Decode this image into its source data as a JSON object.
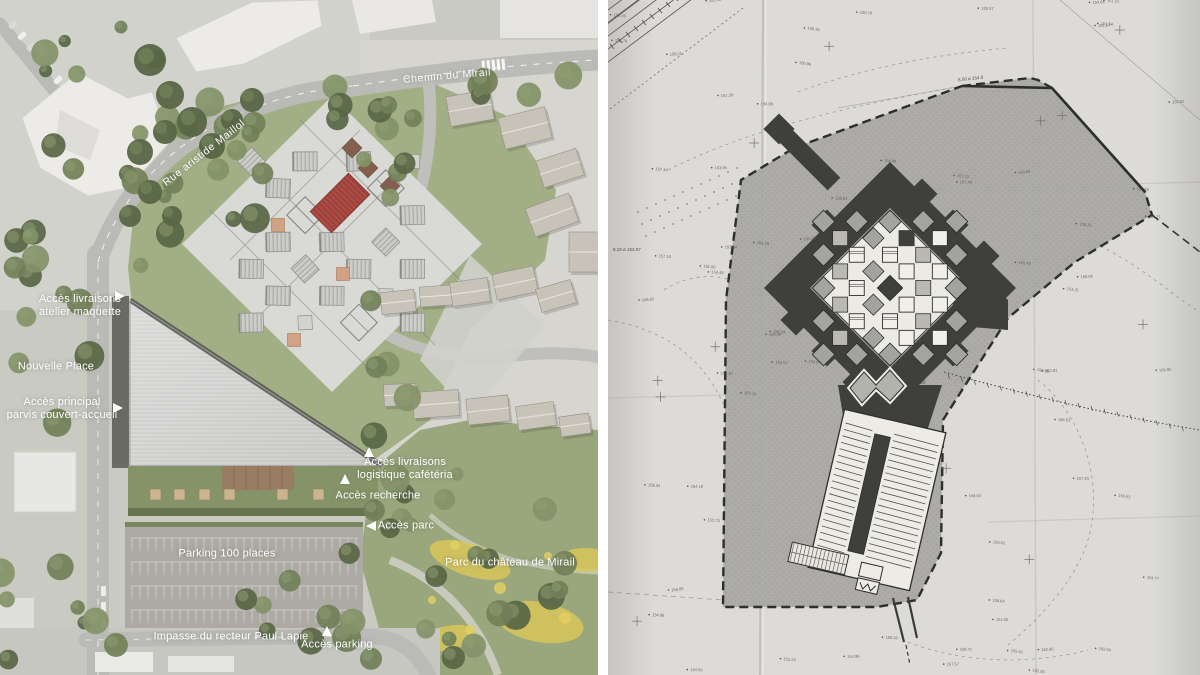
{
  "panels": {
    "left": {
      "type": "aerial-render-site-plan",
      "street_labels": [
        {
          "id": "chemin-du-mirail",
          "text": "Chemin du Mirail",
          "x": 447,
          "y": 76,
          "rotate": -5
        },
        {
          "id": "rue-aristide-maillol",
          "text": "Rue aristide Maillol",
          "x": 204,
          "y": 153,
          "rotate": -38
        }
      ],
      "callouts": [
        {
          "id": "acces-livraisons-atelier",
          "lines": [
            "Accès livraisons",
            "atelier maquette"
          ],
          "x": 80,
          "y": 306,
          "arrow": "right",
          "ax": 120,
          "ay": 296
        },
        {
          "id": "nouvelle-place",
          "lines": [
            "Nouvelle Place"
          ],
          "x": 56,
          "y": 367,
          "arrow": null,
          "ax": 0,
          "ay": 0
        },
        {
          "id": "acces-principal",
          "lines": [
            "Accès principal",
            "parvis couvert-accueil"
          ],
          "x": 62,
          "y": 409,
          "arrow": "right",
          "ax": 118,
          "ay": 408
        },
        {
          "id": "acces-livraisons-logistique",
          "lines": [
            "Accès livraisons",
            "logistique cafétéria"
          ],
          "x": 405,
          "y": 469,
          "arrow": "up",
          "ax": 369,
          "ay": 452
        },
        {
          "id": "acces-recherche",
          "lines": [
            "Accès recherche"
          ],
          "x": 378,
          "y": 496,
          "arrow": "up",
          "ax": 345,
          "ay": 479
        },
        {
          "id": "acces-parc",
          "lines": [
            "Accès parc"
          ],
          "x": 406,
          "y": 526,
          "arrow": "left",
          "ax": 371,
          "ay": 526
        },
        {
          "id": "parking-100-places",
          "lines": [
            "Parking 100 places"
          ],
          "x": 227,
          "y": 554,
          "arrow": null,
          "ax": 0,
          "ay": 0
        },
        {
          "id": "parc-du-chateau-de-mirail",
          "lines": [
            "Parc du château de Mirail"
          ],
          "x": 510,
          "y": 563,
          "arrow": null,
          "ax": 0,
          "ay": 0
        },
        {
          "id": "impasse-du-recteur-paul-lapie",
          "lines": [
            "Impasse du recteur Paul Lapie"
          ],
          "x": 231,
          "y": 637,
          "arrow": null,
          "ax": 0,
          "ay": 0
        },
        {
          "id": "acces-parking",
          "lines": [
            "Accès parking"
          ],
          "x": 337,
          "y": 645,
          "arrow": "up",
          "ax": 327,
          "ay": 631
        }
      ]
    },
    "right": {
      "type": "technical-site-plan-photo",
      "survey_labels": [
        {
          "id": "radius-r50",
          "text": "R 50",
          "x": 306,
          "y": 380,
          "size": 5.5,
          "rotate": -4
        },
        {
          "id": "level-856",
          "text": "8.56 ø 154.9",
          "x": 350,
          "y": 76,
          "size": 4.5,
          "rotate": -6
        },
        {
          "id": "level-819",
          "text": "8.19 ø 154.57",
          "x": 5,
          "y": 247,
          "size": 4.5,
          "rotate": 0
        }
      ]
    }
  },
  "palette": {
    "aerial": {
      "base": "#c7c9c0",
      "urban": "#cfd0ca",
      "eastGround": "#d4d3cd",
      "park": "#95a377",
      "parkLight": "#a6b286",
      "flowers": "#d9c44e",
      "road": "#b7b7b3",
      "roadLine": "#ffffff",
      "building": "#ebeae6",
      "buildingEdge": "#d2d0cc",
      "treeDark": "#4f5e3c",
      "treeMid": "#69794f",
      "treeLight": "#7d8d61",
      "lawn": "#9dab7f",
      "plaza": "#d7d7d4",
      "terrace": "#cfcfcb",
      "pavilion": "#cbcbc8",
      "pavilionRib": "#a2a29f",
      "pavilionEdge": "#8c8c89",
      "trellis": "#7b7b77",
      "red": "#a8423a",
      "redRib": "#8c332d",
      "tan": "#cf9f7e",
      "brown": "#7d5844",
      "roof": "#cdcdcb",
      "roofRib": "#b4b4b2",
      "roofShadow": "#4c4c48",
      "darkStrip": "#62655c",
      "garden": "#7f8f60",
      "deck": "#93765a",
      "hedge": "#5e6e45",
      "benchTan": "#c9b088",
      "asphalt": "#a9a59f",
      "stall": "#d8d8d3",
      "houseRoof": "#c6c0b5",
      "houseEdge": "#8f897e",
      "pathLight": "#cfcfc6"
    },
    "drawing": {
      "paper": "#dcdbd8",
      "paperShade": "#c3c2bf",
      "site": "#a7a7a3",
      "speckle": "#8e8e8a",
      "dark": "#3f3f3b",
      "white": "#eceae5",
      "inner": "#f1efe9",
      "gray": "#a3a39f",
      "tan": "#b9b9b2",
      "line": "#2e2e2c",
      "faint": "#8a8a86",
      "mark": "#55534f",
      "hatch": "#55524e"
    }
  }
}
